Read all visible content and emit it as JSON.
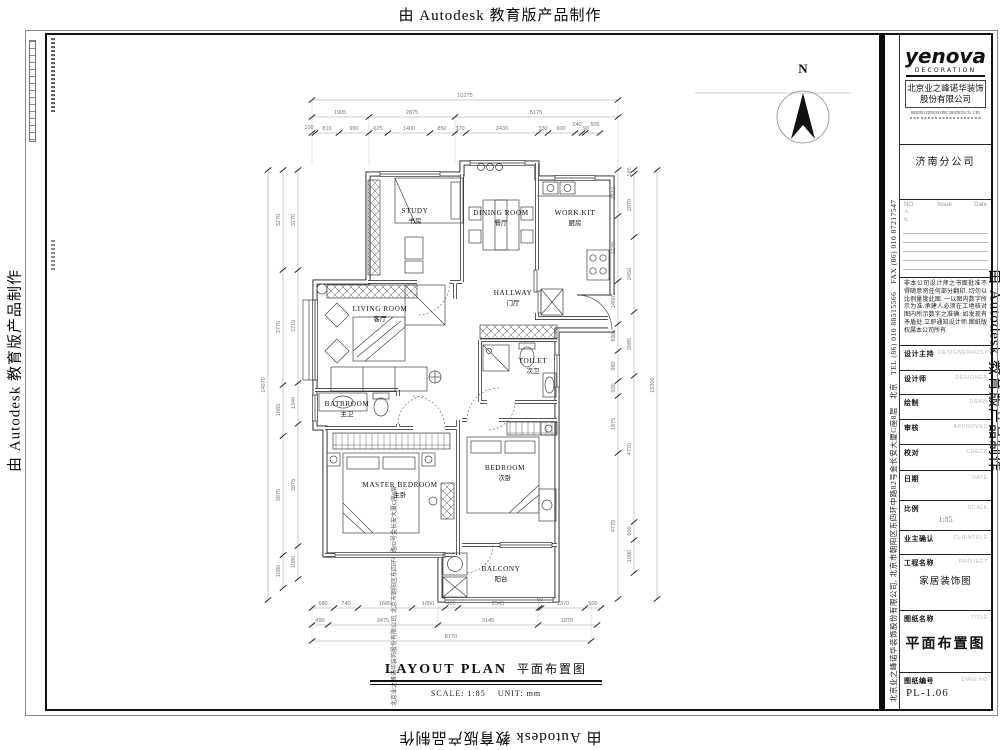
{
  "watermark": "由 Autodesk 教育版产品制作",
  "north_label": "N",
  "rooms": [
    {
      "en": "STUDY",
      "zh": "书房"
    },
    {
      "en": "DINING ROOM",
      "zh": "餐厅"
    },
    {
      "en": "WORK.KIT",
      "zh": "厨房"
    },
    {
      "en": "HALLWAY",
      "zh": "门厅"
    },
    {
      "en": "LIVING ROOM",
      "zh": "客厅"
    },
    {
      "en": "TOILET",
      "zh": "次卫"
    },
    {
      "en": "BATRROOM",
      "zh": "主卫"
    },
    {
      "en": "MASTER BEDROOM",
      "zh": "主卧"
    },
    {
      "en": "BEDROOM",
      "zh": "次卧"
    },
    {
      "en": "BALCONY",
      "zh": "阳台"
    }
  ],
  "dims": {
    "t1": [
      "10275"
    ],
    "t2": [
      "1905",
      "2875",
      "5175"
    ],
    "t3": [
      "100",
      "810",
      "990",
      "625",
      "1400",
      "850",
      "370",
      "2430",
      "330",
      "900",
      "240",
      "90",
      "505"
    ],
    "b1": [
      "680",
      "740",
      "1685",
      "1050",
      "420",
      "2545",
      "60",
      "1370",
      "500"
    ],
    "b2": [
      "490",
      "3475",
      "3145",
      "1870"
    ],
    "b3": [
      "8770"
    ],
    "l1": [
      "3270",
      "3770",
      "1665",
      "3875",
      "1080"
    ],
    "l2": [
      "3270",
      "3710",
      "1340",
      "3975",
      "1080"
    ],
    "l3": [
      "14070"
    ],
    "r1": [
      "1510",
      "2140",
      "1400",
      "890",
      "980",
      "500",
      "1875",
      "4770"
    ],
    "r2": [
      "145",
      "2070",
      "2450",
      "2085",
      "4770",
      "600",
      "1080"
    ],
    "r3": [
      "15300"
    ]
  },
  "plan_title": {
    "en": "LAYOUT PLAN",
    "zh": "平面布置图",
    "scale_label": "SCALE:",
    "scale_value": "1:85",
    "unit_label": "UNIT:",
    "unit_value": "mm"
  },
  "titleblock": {
    "logo": "yenova",
    "logo_sub": "DECORATION",
    "company_line1": "北京业之峰诺华装饰",
    "company_line2": "股份有限公司",
    "company_en": "BEIJING YENOVO DECORATION CO., LTD",
    "branch": "济南分公司",
    "rev_no": "NO.",
    "rev_issue": "Issue",
    "rev_date": "Date",
    "rev_rows": [
      "A",
      "K"
    ],
    "note_lines": [
      "非本公司设计师之书面",
      "批准不得随意将任何部分翻",
      "印. 切勿以比例量度此图. 一",
      "以图内数字所示为准.承建人",
      "必须在工地核对图内所示数",
      "字之准确. 如发现有矛盾处.",
      "立即通知设计师.图纸版权属",
      "本公司所有."
    ],
    "fields": [
      {
        "label": "设计主持",
        "en": "DESIGNERHOST",
        "value": ""
      },
      {
        "label": "设计师",
        "en": "DESIGNER",
        "value": ""
      },
      {
        "label": "绘制",
        "en": "DRAW",
        "value": ""
      },
      {
        "label": "审核",
        "en": "APPROVED",
        "value": ""
      },
      {
        "label": "校对",
        "en": "CHECK",
        "value": ""
      },
      {
        "label": "日期",
        "en": "DATE",
        "value": ""
      },
      {
        "label": "比例",
        "en": "SCALE",
        "value": "1:85"
      },
      {
        "label": "业主确认",
        "en": "CLIENTELE",
        "value": ""
      },
      {
        "label": "工程名称",
        "en": "PROJECT",
        "value": "家居装饰图"
      },
      {
        "label": "图纸名称",
        "en": "TITLE",
        "value": "平面布置图"
      },
      {
        "label": "图纸编号",
        "en": "DWG.NO",
        "value": "PL-1.06"
      }
    ],
    "contact_line": "北京业之峰诺华装饰股份有限公司, 北京市朝阳区东四环中路82号金长安大厦C座8层　北京　TEL (86) 010 88515566　FAX (86) 010 87217547",
    "address_line": "北京业之峰诺华装饰股份有限公司, 北京市朝阳区东四环中路82号金长安大厦C座8层"
  }
}
